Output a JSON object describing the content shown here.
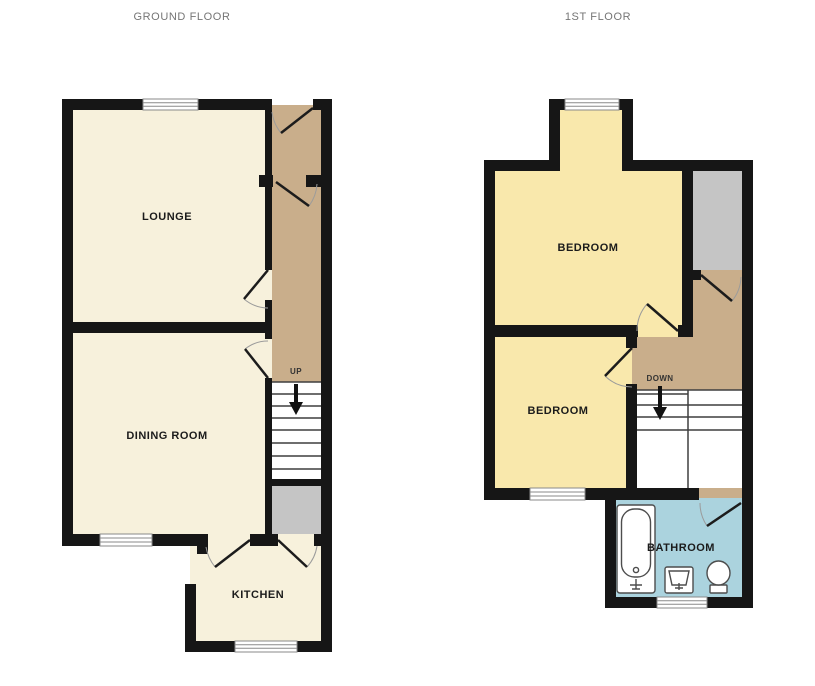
{
  "palette": {
    "wall": "#161616",
    "room_cream": "#F7F1DC",
    "room_yellow": "#F9E8AC",
    "hall_tan": "#C9AE8B",
    "store_gray": "#C5C5C5",
    "bath_blue": "#ABD3DE",
    "door_arc": "#9b9b9b",
    "door_leaf": "#1c1c1c",
    "tread_line": "#3f3f3f",
    "window_frame": "#8a8a8a",
    "fixture_stroke": "#4d4d4d",
    "title_text": "#757575",
    "label_text": "#1b1b1b"
  },
  "floors": {
    "ground": {
      "title": "GROUND FLOOR",
      "rooms": {
        "lounge": "LOUNGE",
        "dining": "DINING ROOM",
        "kitchen": "KITCHEN"
      },
      "stairs_label": "UP",
      "stairs_direction": "down-page"
    },
    "first": {
      "title": "1ST FLOOR",
      "rooms": {
        "bedroom1": "BEDROOM",
        "bedroom2": "BEDROOM",
        "bathroom": "BATHROOM"
      },
      "stairs_label": "DOWN",
      "stairs_direction": "down-page"
    }
  }
}
